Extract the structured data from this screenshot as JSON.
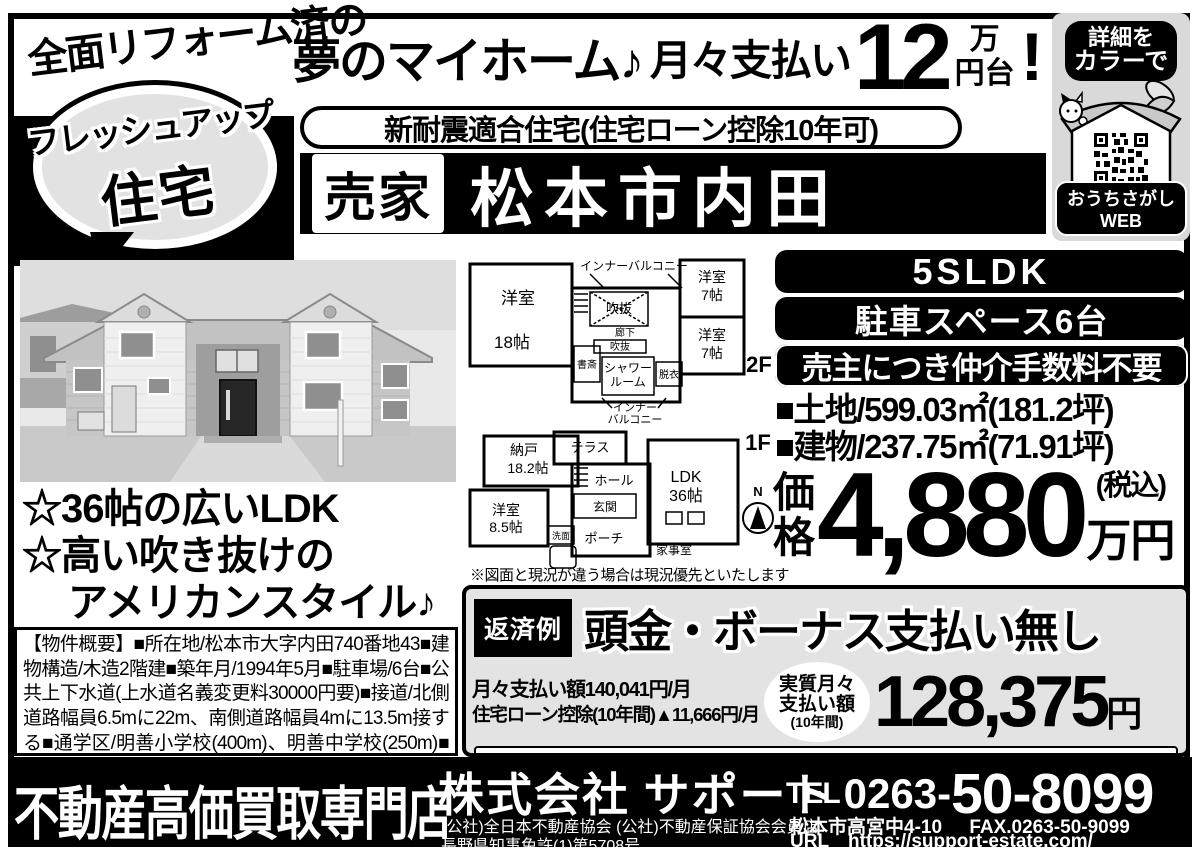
{
  "header": {
    "reform_note": "全面リフォーム済の",
    "bubble_top": "フレッシュアップ",
    "bubble_bottom": "住宅",
    "dream": "夢のマイホーム♪",
    "monthly_label": "月々支払い",
    "monthly_value": "12",
    "unit_top": "万",
    "unit_bottom": "円台",
    "exclaim": "!",
    "quake_pill": "新耐震適合住宅(住宅ローン控除10年可)",
    "for_sale": "売家",
    "location": "松本市内田"
  },
  "qr_panel": {
    "detail_line1": "詳細を",
    "detail_line2": "カラーで",
    "web_label": "おうちさがしWEB"
  },
  "features": {
    "line1": "☆36帖の広いLDK",
    "line2": "☆高い吹き抜けの",
    "line3": "アメリカンスタイル♪"
  },
  "overview": "【物件概要】■所在地/松本市大字内田740番地43■建物構造/木造2階建■築年月/1994年5月■駐車場/6台■公共上下水道(上水道名義変更料30000円要)■接道/北側道路幅員6.5mに22m、南側道路幅員4mに13.5m接する■通学区/明善小学校(400m)、明善中学校(250m)■交通/JR篠ノ井線村井駅3500m■即入居可■売主",
  "floorplan": {
    "note": "※図面と現況が違う場合は現況優先といたします",
    "f2": {
      "label": "2F",
      "balcony_top": "インナーバルコニー",
      "room18a": "洋室",
      "room18b": "18帖",
      "void1": "吹抜",
      "corridor": "廊下",
      "void2": "吹抜",
      "study": "書斎",
      "shower1": "シャワー",
      "shower2": "ルーム",
      "dress": "脱衣",
      "balcony_b1": "インナー",
      "balcony_b2": "バルコニー",
      "room7a1": "洋室",
      "room7a2": "7帖",
      "room7b1": "洋室",
      "room7b2": "7帖"
    },
    "f1": {
      "label": "1F",
      "terrace": "テラス",
      "storage1": "納戸",
      "storage2": "18.2帖",
      "hall": "ホール",
      "entrance": "玄関",
      "room85a": "洋室",
      "room85b": "8.5帖",
      "wash": "洗面",
      "porch": "ポーチ",
      "utility": "家事室",
      "ldk1": "LDK",
      "ldk2": "36帖",
      "compass_n": "N"
    }
  },
  "specs": {
    "layout": "5SLDK",
    "parking": "駐車スペース6台",
    "no_broker_fee": "売主につき仲介手数料不要",
    "land": "■土地/599.03㎡(181.2坪)",
    "building": "■建物/237.75㎡(71.91坪)",
    "price_label1": "価",
    "price_label2": "格",
    "price_value": "4,880",
    "price_tax": "(税込)",
    "price_unit": "万円"
  },
  "repayment": {
    "badge": "返済例",
    "headline": "頭金・ボーナス支払い無し",
    "monthly": "月々支払い額140,041円/月",
    "deduction": "住宅ローン控除(10年間)▲11,666円/月",
    "real1": "実質月々",
    "real2": "支払い額",
    "real3": "(10年間)",
    "amount": "128,375",
    "amount_unit": "円",
    "note": "※八十二銀行住宅ローン変動金利1.1%、35年返済(420回)、借入金額合計4,880万円(諸費用別途)"
  },
  "footer": {
    "shop_type": "不動産高価買取専門店",
    "company": "株式会社 サポート",
    "memberships": "(公社)全日本不動産協会 (公社)不動産保証協会会員店",
    "license": "長野県知事免許(1)第5708号",
    "tel_label": "TEL",
    "tel_prefix": "0263-",
    "tel_main": "50-8099",
    "address": "松本市高宮中4-10",
    "fax": "FAX.0263-50-9099",
    "url_label": "URL",
    "url": "https://support-estate.com/"
  }
}
